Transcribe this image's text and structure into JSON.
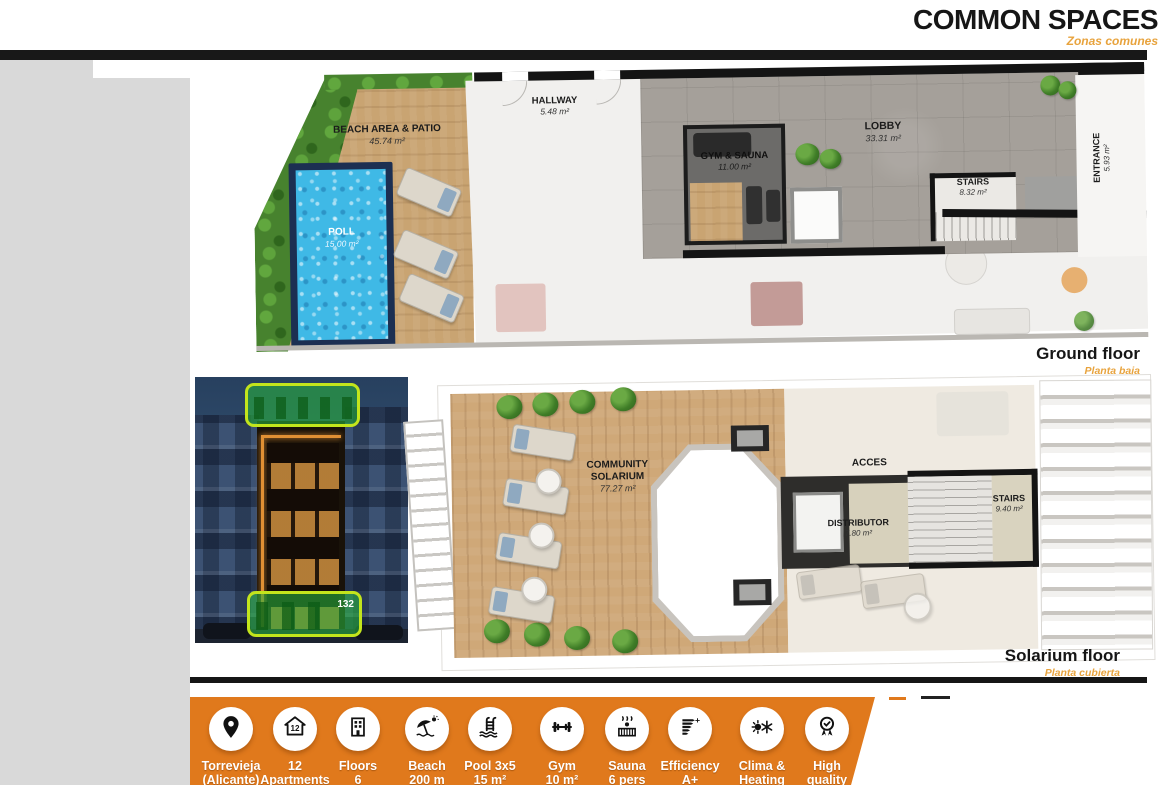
{
  "header": {
    "title": "COMMON SPACES",
    "subtitle": "Zonas comunes"
  },
  "ground_floor": {
    "caption": "Ground floor",
    "caption_es": "Planta baja",
    "rooms": {
      "beach": {
        "name": "BEACH AREA & PATIO",
        "area": "45.74 m²"
      },
      "hallway": {
        "name": "HALLWAY",
        "area": "5.48 m²"
      },
      "pool": {
        "name": "POLL",
        "area": "15.00 m²"
      },
      "gym": {
        "name": "GYM & SAUNA",
        "area": "11.00 m²"
      },
      "lobby": {
        "name": "LOBBY",
        "area": "33.31 m²"
      },
      "stairs": {
        "name": "STAIRS",
        "area": "8.32 m²"
      },
      "entrance": {
        "name": "ENTRANCE",
        "area": "5.93 m²"
      }
    }
  },
  "solarium_floor": {
    "caption": "Solarium floor",
    "caption_es": "Planta cubierta",
    "rooms": {
      "solarium": {
        "line1": "COMMUNITY",
        "line2": "SOLARIUM",
        "area": "77.27 m²"
      },
      "acces": {
        "name": "ACCES"
      },
      "distributor": {
        "name": "DISTRIBUTOR",
        "area": "7.80 m²"
      },
      "stairs": {
        "name": "STAIRS",
        "area": "9.40 m²"
      }
    }
  },
  "building_photo": {
    "number": "132"
  },
  "features": [
    {
      "icon": "location-pin-icon",
      "line1": "Torrevieja",
      "line2": "(Alicante)"
    },
    {
      "icon": "apartments-icon",
      "line1": "12",
      "line2": "Apartments"
    },
    {
      "icon": "floors-icon",
      "line1": "Floors",
      "line2": "6"
    },
    {
      "icon": "beach-icon",
      "line1": "Beach",
      "line2": "200 m"
    },
    {
      "icon": "pool-icon",
      "line1": "Pool 3x5",
      "line2": "15 m²"
    },
    {
      "icon": "gym-icon",
      "line1": "Gym",
      "line2": "10 m²"
    },
    {
      "icon": "sauna-icon",
      "line1": "Sauna",
      "line2": "6 pers"
    },
    {
      "icon": "efficiency-icon",
      "line1": "Efficiency",
      "line2": "A+"
    },
    {
      "icon": "clima-icon",
      "line1": "Clima &",
      "line2": "Heating"
    },
    {
      "icon": "quality-icon",
      "line1": "High",
      "line2": "quality"
    }
  ],
  "colors": {
    "accent_orange": "#e0791c",
    "subtitle_orange": "#e8a33d",
    "bar_black": "#181818"
  }
}
